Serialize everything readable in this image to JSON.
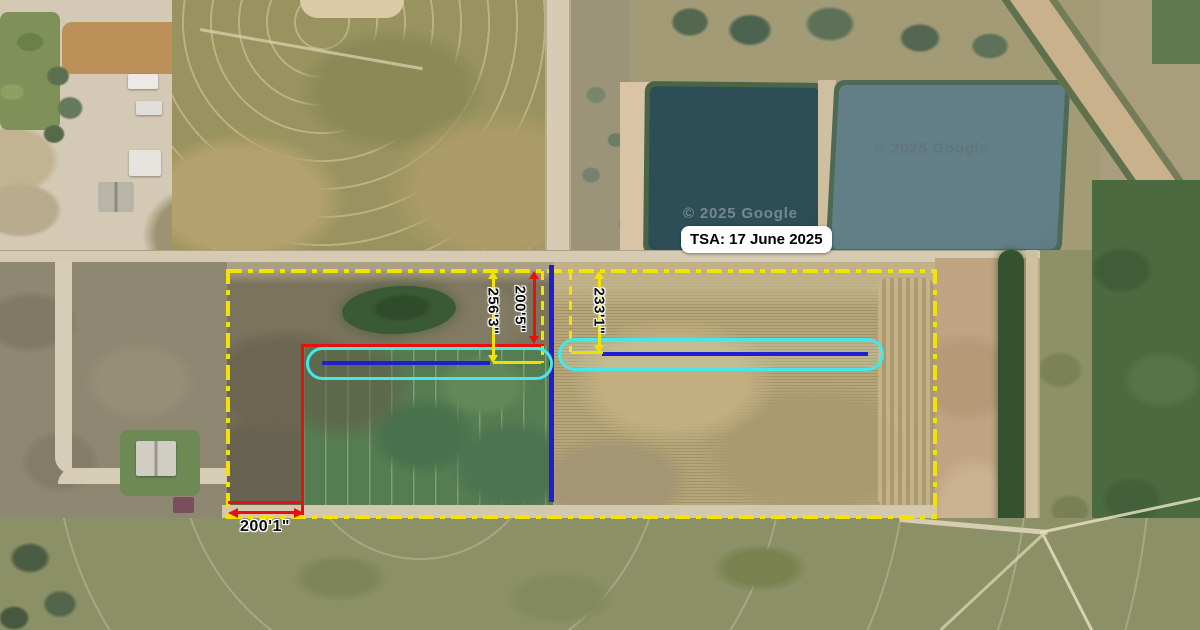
{
  "map": {
    "tsa_box_label": "TSA: 17 June 2025",
    "watermark_text": "© 2025 Google",
    "measurements": {
      "left_field_width": "256'3\"",
      "left_red_offset": "200'5\"",
      "right_field_width": "233'1\"",
      "bottom_offset": "200'1\""
    },
    "colors": {
      "boundary_yellow": "#f4e300",
      "measure_red": "#e80f0f",
      "line_blue": "#1f1fd0",
      "highlight_cyan": "#45e6ee"
    }
  }
}
